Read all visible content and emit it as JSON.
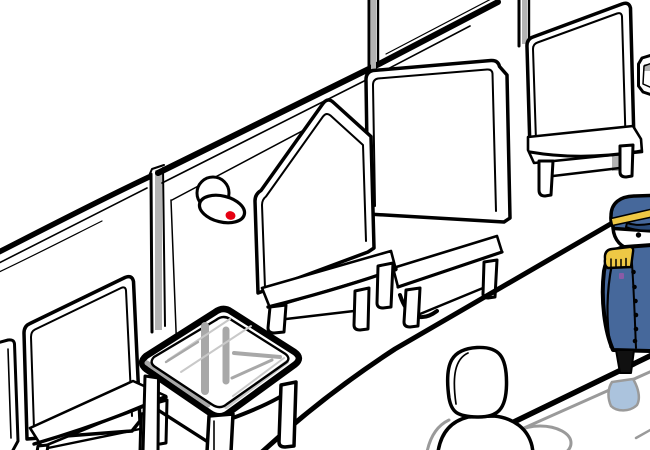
{
  "scene": {
    "description": "Hand-drawn adventure-game scene: interior of a train car with rows of tall white bench seats along a paneled wall, a glass-top table between seats, a wall lamp with red indicator, a conductor in a blue uniform standing in the aisle at right, and a bald passenger seated in the foreground whose head is reflected on the glossy surface below."
  },
  "objects": [
    {
      "name": "train-car-wall",
      "kind": "background"
    },
    {
      "name": "wall-seam-post",
      "kind": "structure"
    },
    {
      "name": "emergency-lamp",
      "kind": "hotspot",
      "detail": "white dome and tilted oval plate with red indicator light"
    },
    {
      "name": "bench-seat",
      "kind": "furniture",
      "count": 6
    },
    {
      "name": "glass-table",
      "kind": "hotspot",
      "detail": "rounded glass top showing gray legs and rails through it"
    },
    {
      "name": "platform-edge",
      "kind": "floor-line"
    },
    {
      "name": "aisle-edge",
      "kind": "floor-line"
    },
    {
      "name": "passenger-bald-head",
      "kind": "character"
    },
    {
      "name": "conductor",
      "kind": "character",
      "detail": "blue cap with gold band, gold epaulette, buttoned blue coat"
    },
    {
      "name": "floor-reflections",
      "kind": "effect",
      "detail": "gray head reflection ellipse and pale blue conductor reflection"
    }
  ],
  "colors": {
    "paper": "#ffffff",
    "ink": "#000000",
    "indicatorRed": "#e60012",
    "uniformBlue": "#46689b",
    "capNavy": "#2a4a78",
    "gold": "#eec845",
    "reflectionBlue": "#abc3dd",
    "grayLine": "#9a9a9a",
    "seamGray": "#b3b3b3",
    "glassGray": "#a8a8a8",
    "glassLight": "#c9c9c9",
    "badgePurple": "#8a5ba6",
    "trouser": "#101010"
  }
}
